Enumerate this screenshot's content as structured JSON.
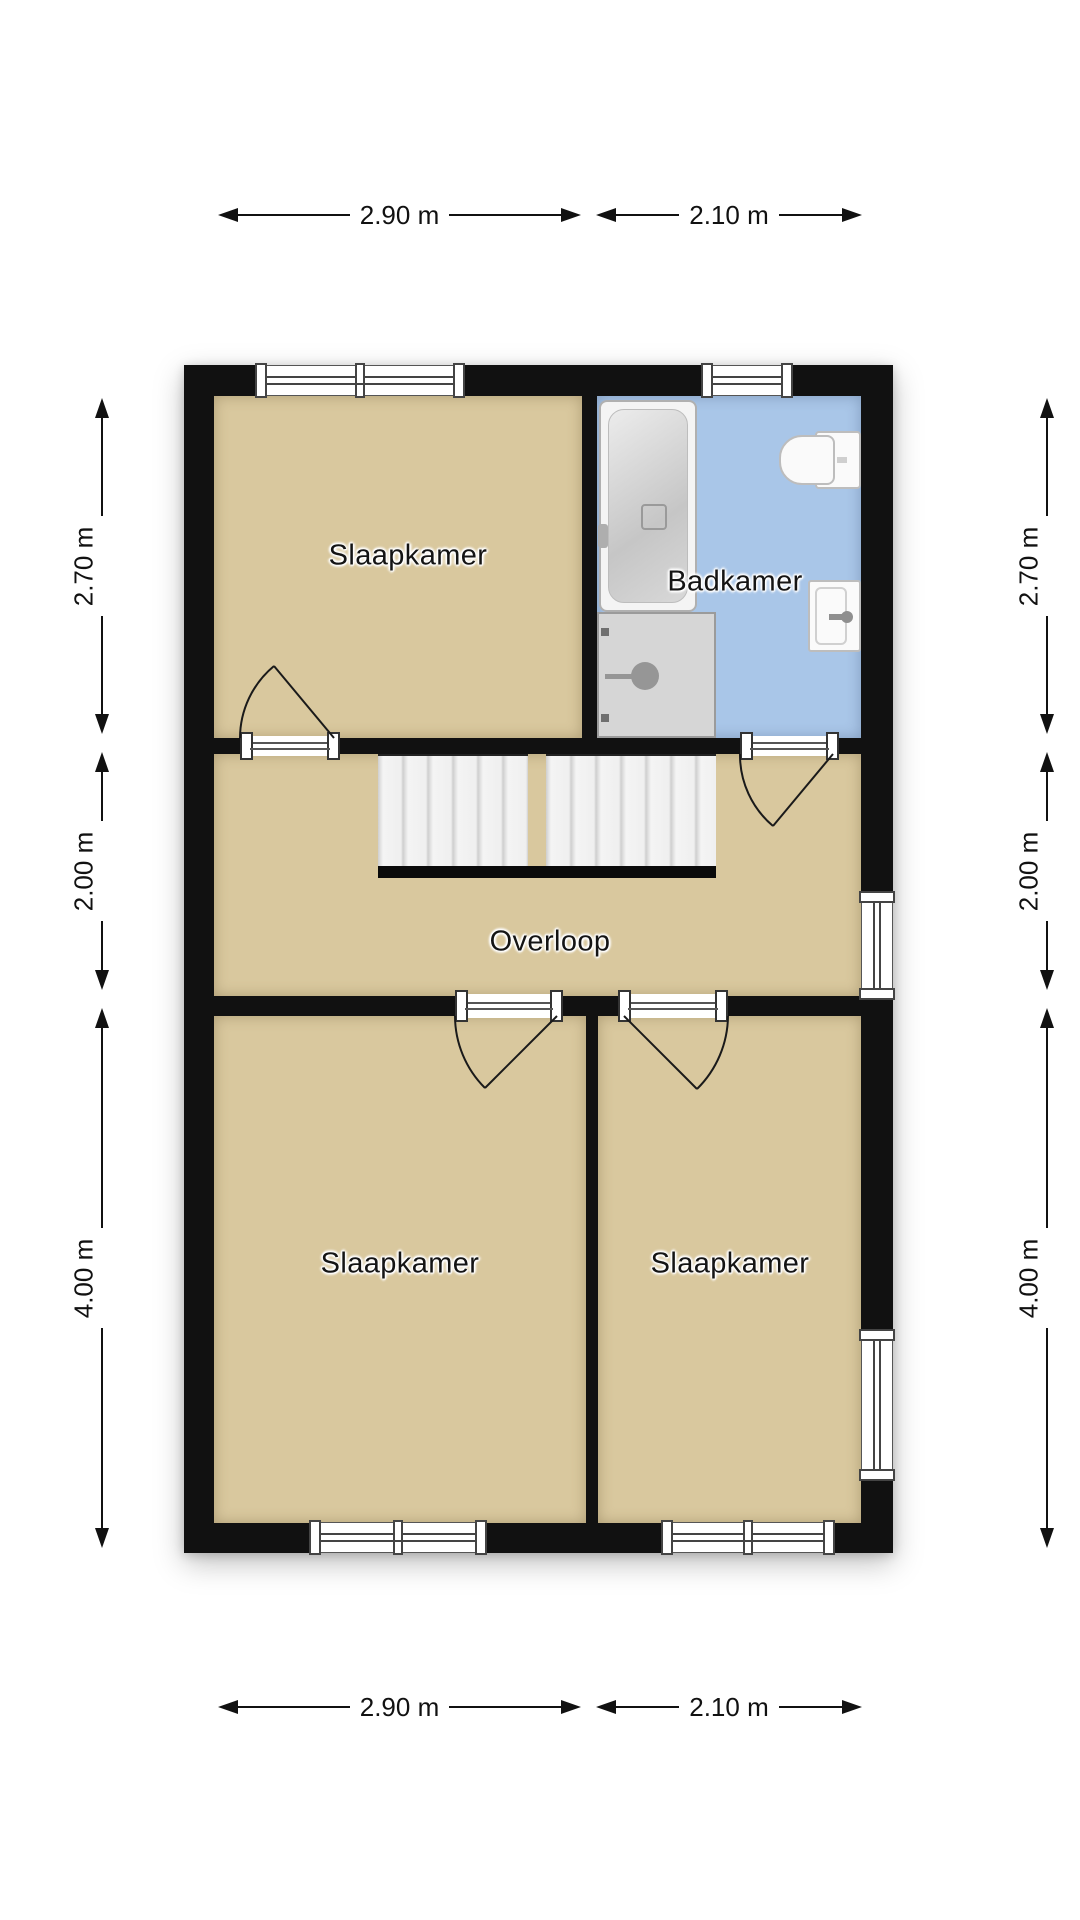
{
  "rooms": {
    "top_left": "Slaapkamer",
    "bathroom": "Badkamer",
    "landing": "Overloop",
    "bottom_left": "Slaapkamer",
    "bottom_right": "Slaapkamer"
  },
  "dimensions": {
    "top": [
      "2.90 m",
      "2.10 m"
    ],
    "bottom": [
      "2.90 m",
      "2.10 m"
    ],
    "left": [
      "2.70 m",
      "2.00 m",
      "4.00 m"
    ],
    "right": [
      "2.70 m",
      "2.00 m",
      "4.00 m"
    ]
  },
  "fixtures": [
    "bathtub",
    "shower",
    "toilet",
    "sink",
    "staircase"
  ],
  "colors": {
    "floor": "#d9c89e",
    "bathroom_floor": "#a9c6e8",
    "wall": "#111111",
    "background": "#ffffff"
  }
}
